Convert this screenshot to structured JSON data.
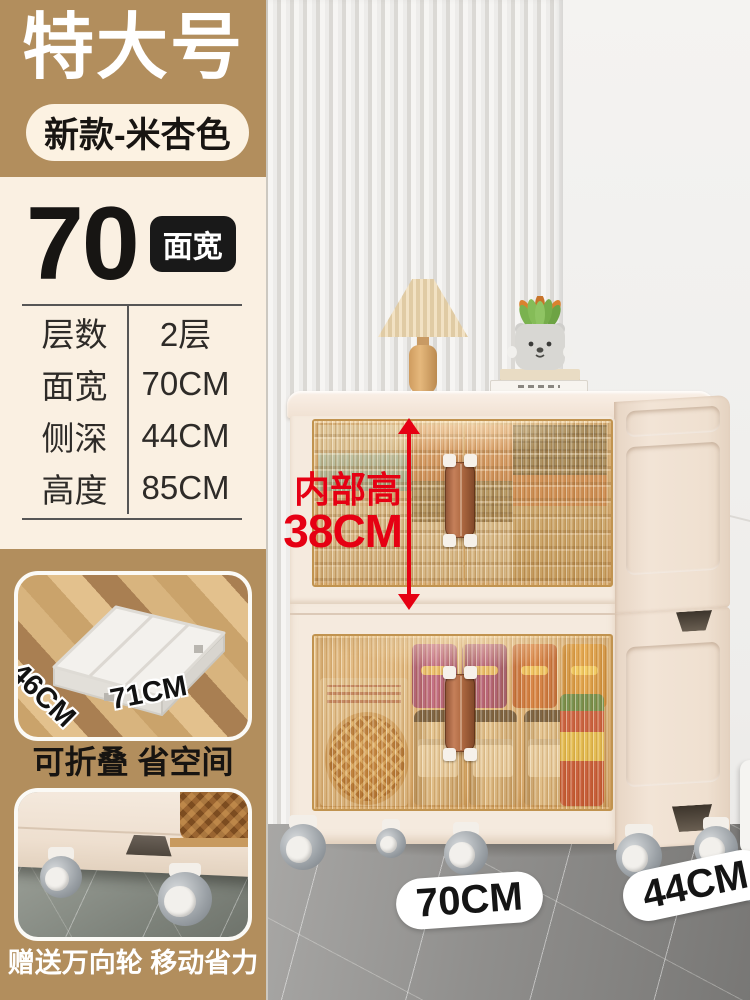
{
  "colors": {
    "tan": "#b28e5d",
    "cream_panel": "#faf0e2",
    "badge_cream": "#fcf2e2",
    "accent_red": "#e60013",
    "ink": "#171513"
  },
  "header": {
    "size_label": "特大号",
    "variant_label": "新款-米杏色"
  },
  "spec": {
    "width_value": "70",
    "width_badge": "面宽",
    "rows": [
      {
        "label": "层数",
        "value": "2层"
      },
      {
        "label": "面宽",
        "value": "70CM"
      },
      {
        "label": "侧深",
        "value": "44CM"
      },
      {
        "label": "高度",
        "value": "85CM"
      }
    ]
  },
  "annotation": {
    "inner_height_label": "内部高",
    "inner_height_value": "38CM"
  },
  "floor_labels": {
    "width": "70CM",
    "depth": "44CM"
  },
  "inset_fold": {
    "dim_depth": "46CM",
    "dim_width": "71CM",
    "caption": "可折叠 省空间"
  },
  "inset_wheels": {
    "caption": "赠送万向轮 移动省力"
  }
}
